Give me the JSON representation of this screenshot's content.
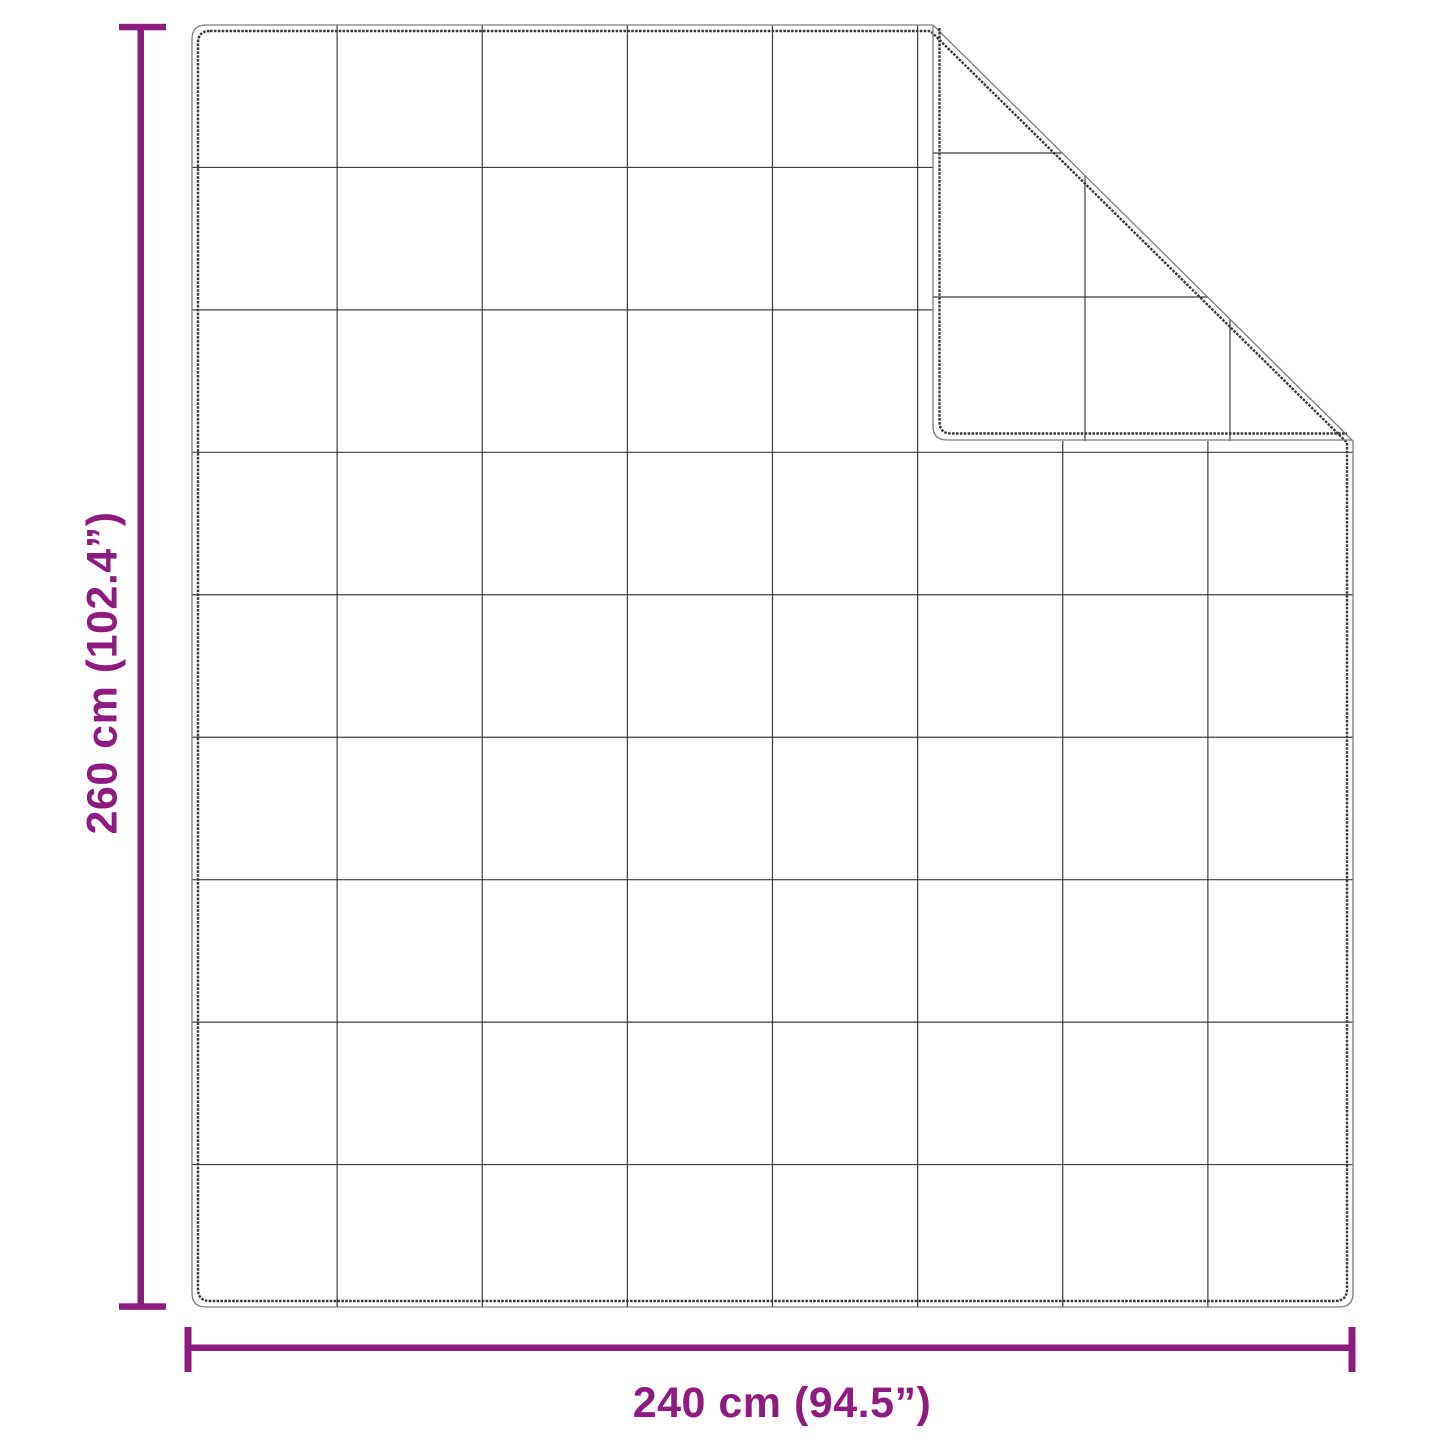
{
  "diagram": {
    "type": "product-dimension-diagram",
    "subject": "quilted-blanket-with-folded-corner",
    "background_color": "#ffffff",
    "accent_color": "#8e1b80",
    "outline_color": "#3a3a3a",
    "grid_color": "#2e2e2e",
    "width_dimension": {
      "label": "240 cm (94.5”)",
      "value_cm": 240,
      "value_inches": 94.5
    },
    "height_dimension": {
      "label": "260 cm (102.4”)",
      "value_cm": 260,
      "value_inches": 102.4
    },
    "grid": {
      "columns": 8,
      "rows": 9
    }
  }
}
